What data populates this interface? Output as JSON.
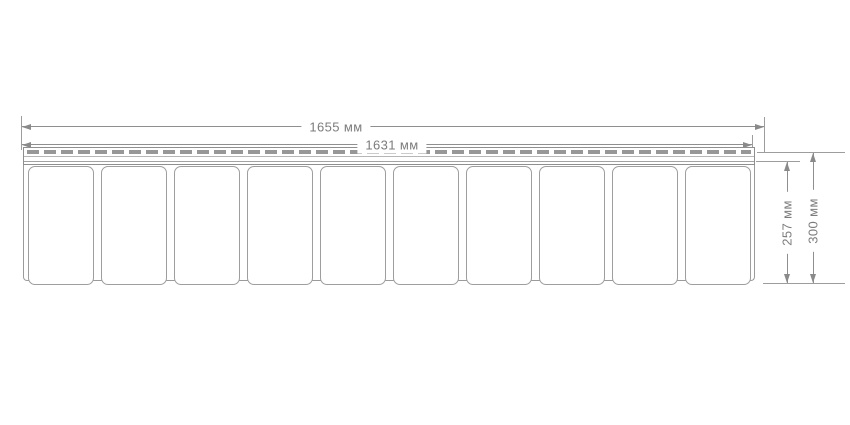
{
  "dimensions": {
    "total_width_label": "1655 мм",
    "inner_width_label": "1631 мм",
    "exposed_height_label": "257 мм",
    "total_height_label": "300 мм"
  },
  "panel": {
    "segment_count": 10
  },
  "colors": {
    "background": "#ffffff",
    "outline": "#9b9b9b",
    "dimension_line": "#8f8f8f",
    "nail_slot": "#979797",
    "text": "#7c7c7c"
  }
}
